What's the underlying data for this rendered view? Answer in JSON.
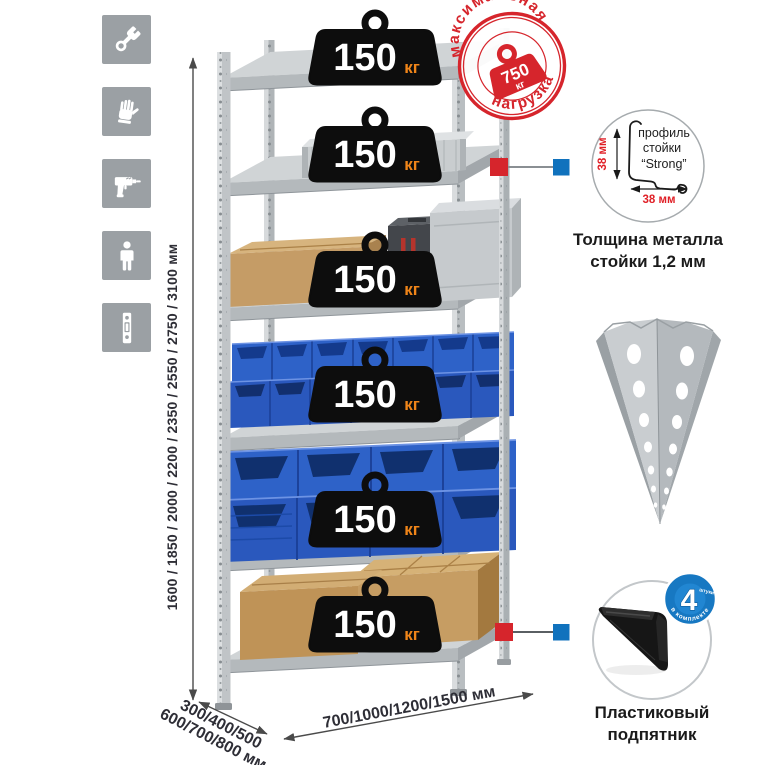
{
  "sidebar": {
    "icons": [
      {
        "name": "wrench-icon"
      },
      {
        "name": "gloves-icon"
      },
      {
        "name": "drill-icon"
      },
      {
        "name": "person-icon"
      },
      {
        "name": "perforated-post-icon"
      }
    ]
  },
  "height_dimension": {
    "label": "1600 / 1850 / 2000 / 2200 / 2350 / 2550 / 2750 / 3100 мм"
  },
  "rack": {
    "badges": [
      {
        "value": "150",
        "unit": "кг"
      },
      {
        "value": "150",
        "unit": "кг"
      },
      {
        "value": "150",
        "unit": "кг"
      },
      {
        "value": "150",
        "unit": "кг"
      },
      {
        "value": "150",
        "unit": "кг"
      },
      {
        "value": "150",
        "unit": "кг"
      }
    ]
  },
  "max_load_stamp": {
    "arc_top": "максимальная",
    "arc_bottom": "нагрузка",
    "value": "750",
    "unit": "кг"
  },
  "profile_detail": {
    "label_line1": "профиль",
    "label_line2": "стойки",
    "label_line3": "“Strong”",
    "vertical_dim": "38 мм",
    "horizontal_dim": "38 мм",
    "caption_line1": "Толщина металла",
    "caption_line2": "стойки 1,2 мм"
  },
  "foot_detail": {
    "caption_line1": "Пластиковый",
    "caption_line2": "подпятник",
    "badge_value": "4",
    "badge_qty_label": "штуки",
    "badge_arc": "в комплекте"
  },
  "depth_dimension": {
    "line1": "300/400/500",
    "line2": "600/700/800 мм"
  },
  "width_dimension": {
    "label": "700/1000/1200/1500 мм"
  },
  "colors": {
    "accent_red": "#d6252c",
    "accent_blue": "#1072bd",
    "badge_black": "#0d0d0d",
    "unit_orange": "#f08519",
    "bin_blue": "#2e62c8",
    "metal_gray": "#c4c8ca",
    "icon_gray": "#9ba0a4"
  }
}
